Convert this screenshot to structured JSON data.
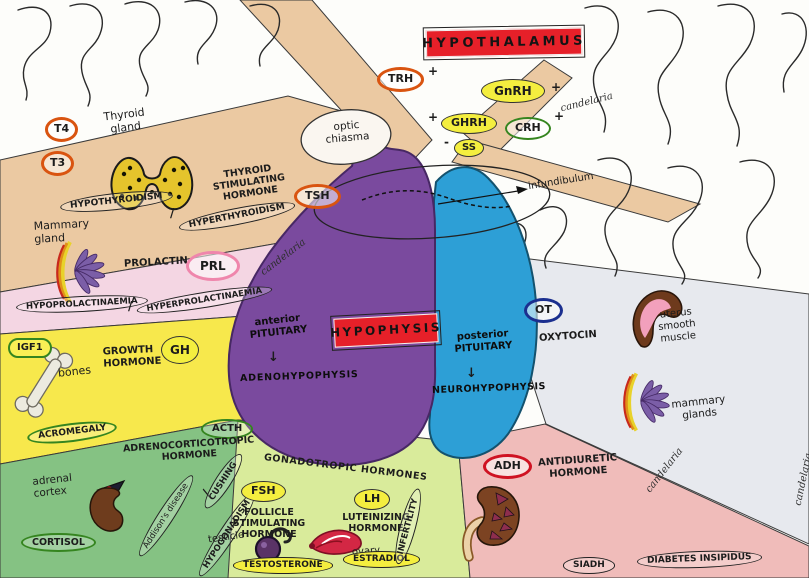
{
  "watermark": "candelaria",
  "misc": {
    "slash": "/",
    "plus": "+",
    "minus": "-",
    "arrow_down": "↓"
  },
  "hypothalamus": {
    "title": "HYPOTHALAMUS",
    "trh": "TRH",
    "gnrh": "GnRH",
    "ghrh": "GHRH",
    "ss": "SS",
    "crh": "CRH"
  },
  "anatomy": {
    "optic_chiasma": "optic chiasma",
    "infundibulum": "infundibulum"
  },
  "hypophysis": {
    "title": "HYPOPHYSIS",
    "anterior": "anterior PITUITARY",
    "adenohypophysis": "ADENOHYPOPHYSIS",
    "posterior": "posterior PITUITARY",
    "neurohypophysis": "NEUROHYPOPHYSIS"
  },
  "thyroid_axis": {
    "t4": "T4",
    "t3": "T3",
    "organ": "Thyroid gland",
    "hormone": "THYROID STIMULATING HORMONE",
    "abbr": "TSH",
    "hypo": "HYPOTHYROIDISM",
    "hyper": "HYPERTHYROIDISM"
  },
  "prolactin_axis": {
    "organ": "Mammary gland",
    "hormone": "PROLACTIN",
    "abbr": "PRL",
    "hypo": "HYPOPROLACTINAEMIA",
    "hyper": "HYPERPROLACTINAEMIA"
  },
  "growth_axis": {
    "igf1": "IGF1",
    "target": "bones",
    "hormone": "GROWTH HORMONE",
    "abbr": "GH",
    "disorder": "ACROMEGALY"
  },
  "acth_axis": {
    "abbr": "ACTH",
    "hormone": "ADRENOCORTICOTROPIC HORMONE",
    "organ": "adrenal cortex",
    "product": "CORTISOL",
    "addisons": "Addison's disease",
    "cushing": "CUSHING"
  },
  "gonadotropic_axis": {
    "hormones": "GONADOTROPIC HORMONES",
    "fsh": "FSH",
    "fsh_full": "FOLLICLE STIMULATING HORMONE",
    "testicle": "testicle",
    "lh": "LH",
    "lh_full": "LUTEINIZING HORMONE",
    "ovary": "ovary",
    "testosterone": "TESTOSTERONE",
    "estradiol": "ESTRADIOL",
    "infertility": "INFERTILITY",
    "hypogonadism": "HYPOGONADISM"
  },
  "oxytocin_axis": {
    "abbr": "OT",
    "hormone": "OXYTOCIN",
    "target_1": "uterus smooth muscle",
    "target_2": "mammary glands"
  },
  "adh_axis": {
    "abbr": "ADH",
    "hormone": "ANTIDIURETIC HORMONE",
    "siadh": "SIADH",
    "diabetes": "DIABETES INSIPIDUS"
  }
}
